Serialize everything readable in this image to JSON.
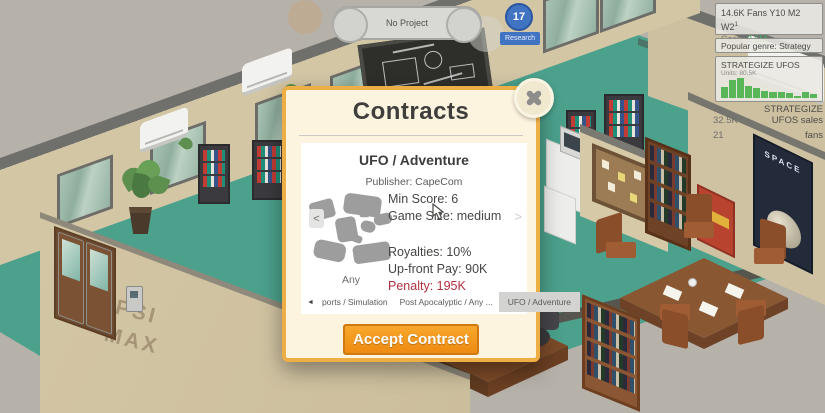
{
  "hud": {
    "project_bar_label": "No Project",
    "research_count": "17",
    "research_label": "Research",
    "stats": {
      "fans_line": "14.6K Fans Y10 M2 W2",
      "fans_sup": "1",
      "cash_label": "Cash:",
      "cash_value": "2.6M"
    },
    "popular_genre": "Popular genre: Strategy",
    "sales_panel": {
      "title": "STRATEGIZE UFOS",
      "units_label": "Units: 80.5K"
    },
    "sales_summary": [
      {
        "value": "32.5K",
        "label": "STRATEGIZE UFOS sales"
      },
      {
        "value": "21",
        "label": "fans"
      }
    ]
  },
  "dialog": {
    "title": "Contracts",
    "contract": {
      "name": "UFO / Adventure",
      "publisher": "Publisher: CapeCom",
      "min_score": "Min Score: 6",
      "game_size": "Game Size: medium",
      "royalties": "Royalties: 10%",
      "upfront": "Up-front Pay: 90K",
      "penalty": "Penalty: 195K",
      "platform": "Any"
    },
    "carousel": {
      "prev": "<",
      "next": ">"
    },
    "tabs_nav_prev": "◄",
    "tabs": [
      {
        "label": "ports / Simulation",
        "selected": false
      },
      {
        "label": "Post Apocalyptic / Any ...",
        "selected": false
      },
      {
        "label": "UFO / Adventure",
        "selected": true
      }
    ],
    "accept_label": "Accept Contract"
  },
  "scene": {
    "wall_brand_line1": "PEPSI",
    "wall_brand_line2": "MAX",
    "poster_title": "SPACE"
  },
  "chart_data": {
    "type": "bar",
    "title": "STRATEGIZE UFOS",
    "subtitle": "Units: 80.5K",
    "x": [
      1,
      2,
      3,
      4,
      5,
      6,
      7,
      8,
      9,
      10,
      11,
      12
    ],
    "values": [
      55,
      88,
      100,
      62,
      52,
      36,
      28,
      32,
      24,
      12,
      30,
      20
    ],
    "values_note": "relative bar heights in % of tallest bar; weekly unit sales sparkline, total units 80.5K",
    "bar_color": "#58b558",
    "xlabel": "",
    "ylabel": "",
    "axes": "none",
    "grid": false,
    "legend": "none"
  },
  "colors": {
    "accent_orange": "#f09018",
    "dialog_border": "#ecae45",
    "cash_green": "#3fae62",
    "penalty_red": "#b03040",
    "research_blue": "#4073c2",
    "bar_green": "#58b558",
    "floor_teal": "#4ba18c",
    "wall_beige": "#d3c6a5",
    "tab_selected_bg": "#d3d3d1"
  }
}
